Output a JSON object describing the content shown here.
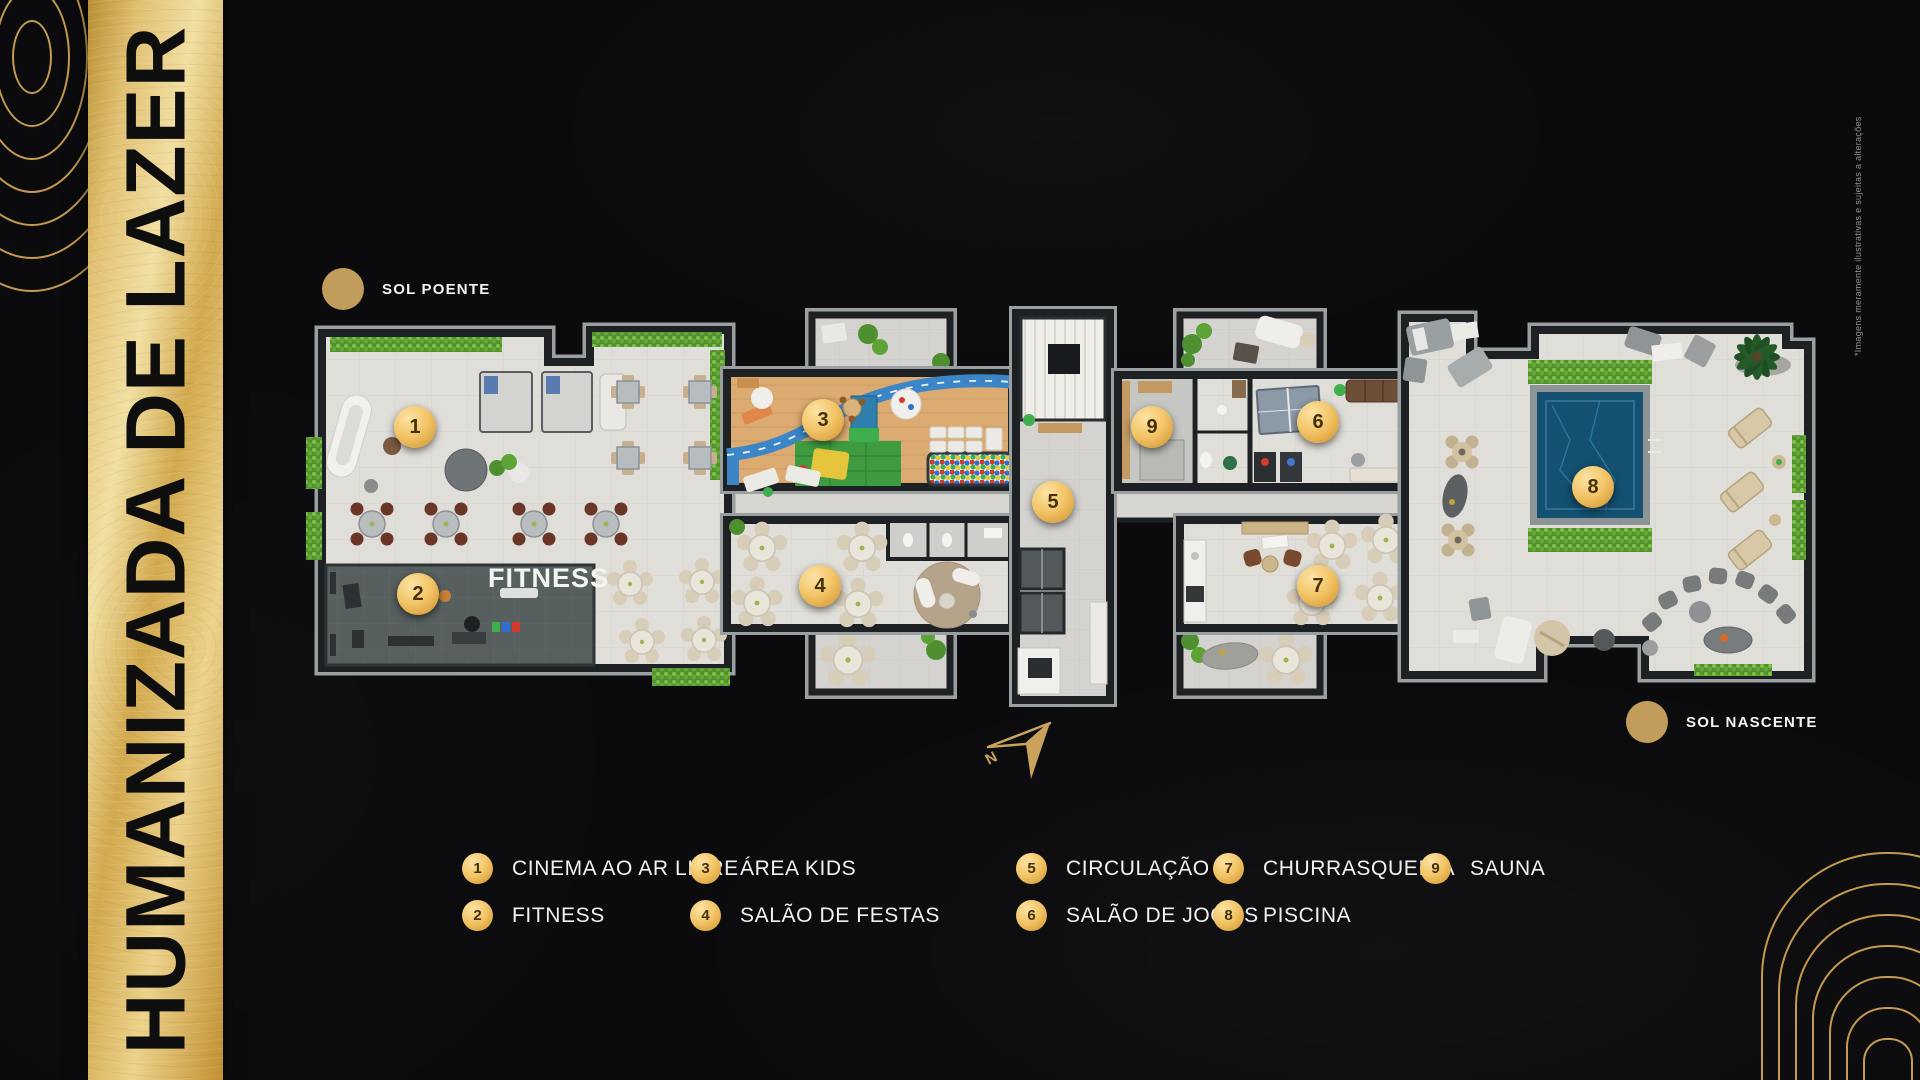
{
  "banner": {
    "title": "HUMANIZADA DE LAZER"
  },
  "sun_markers": {
    "west": "SOL POENTE",
    "east": "SOL NASCENTE"
  },
  "compass": {
    "north_label": "N"
  },
  "plan": {
    "fitness_label": "FITNESS"
  },
  "disclaimer": "*Imagens meramente ilustrativas e sujeitas a alterações",
  "colors": {
    "background": "#0b0b0d",
    "gold": "#d4a945",
    "gold_light": "#f3dc9b",
    "ornament_gold": "#c39a4e",
    "sun_dot": "#c29c5b",
    "badge_text": "#453008",
    "hedge_green": "#69aa3e",
    "pool_blue": "#14506f",
    "wood": "#dcab72",
    "fitness_floor": "#57605e"
  },
  "plan_badges": [
    {
      "number": "1",
      "x": 415,
      "y": 427
    },
    {
      "number": "2",
      "x": 418,
      "y": 594
    },
    {
      "number": "3",
      "x": 823,
      "y": 420
    },
    {
      "number": "4",
      "x": 820,
      "y": 586
    },
    {
      "number": "5",
      "x": 1053,
      "y": 502
    },
    {
      "number": "6",
      "x": 1318,
      "y": 422
    },
    {
      "number": "7",
      "x": 1318,
      "y": 586
    },
    {
      "number": "8",
      "x": 1593,
      "y": 487
    },
    {
      "number": "9",
      "x": 1152,
      "y": 427
    }
  ],
  "legend": {
    "items": [
      {
        "number": "1",
        "label": "CINEMA AO AR LIVRE",
        "col": 0,
        "row": 0
      },
      {
        "number": "2",
        "label": "FITNESS",
        "col": 0,
        "row": 1
      },
      {
        "number": "3",
        "label": "ÁREA KIDS",
        "col": 1,
        "row": 0
      },
      {
        "number": "4",
        "label": "SALÃO DE FESTAS",
        "col": 1,
        "row": 1
      },
      {
        "number": "5",
        "label": "CIRCULAÇÃO",
        "col": 2,
        "row": 0
      },
      {
        "number": "6",
        "label": "SALÃO DE JOGOS",
        "col": 2,
        "row": 1
      },
      {
        "number": "7",
        "label": "CHURRASQUEIRA",
        "col": 3,
        "row": 0
      },
      {
        "number": "8",
        "label": "PISCINA",
        "col": 3,
        "row": 1
      },
      {
        "number": "9",
        "label": "SAUNA",
        "col": 4,
        "row": 0
      }
    ]
  }
}
